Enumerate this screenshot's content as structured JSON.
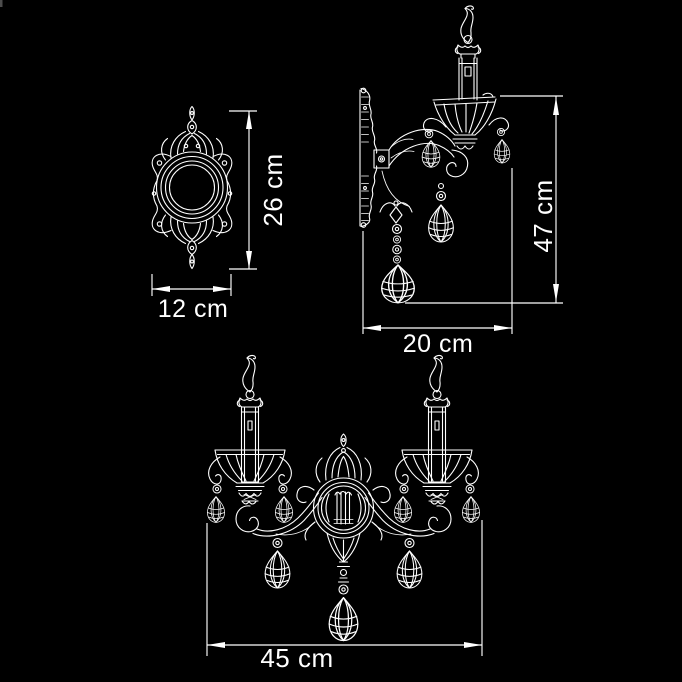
{
  "drawing": {
    "title": "wall sconce dimensional drawing",
    "colors": {
      "background": "#000000",
      "line": "#ffffff",
      "text": "#ffffff"
    },
    "views": {
      "backplate_front": {
        "height_label": "26 cm",
        "width_label": "12 cm"
      },
      "sconce_side": {
        "height_label": "47 cm",
        "depth_label": "20 cm"
      },
      "sconce_front": {
        "width_label": "45 cm"
      }
    }
  }
}
